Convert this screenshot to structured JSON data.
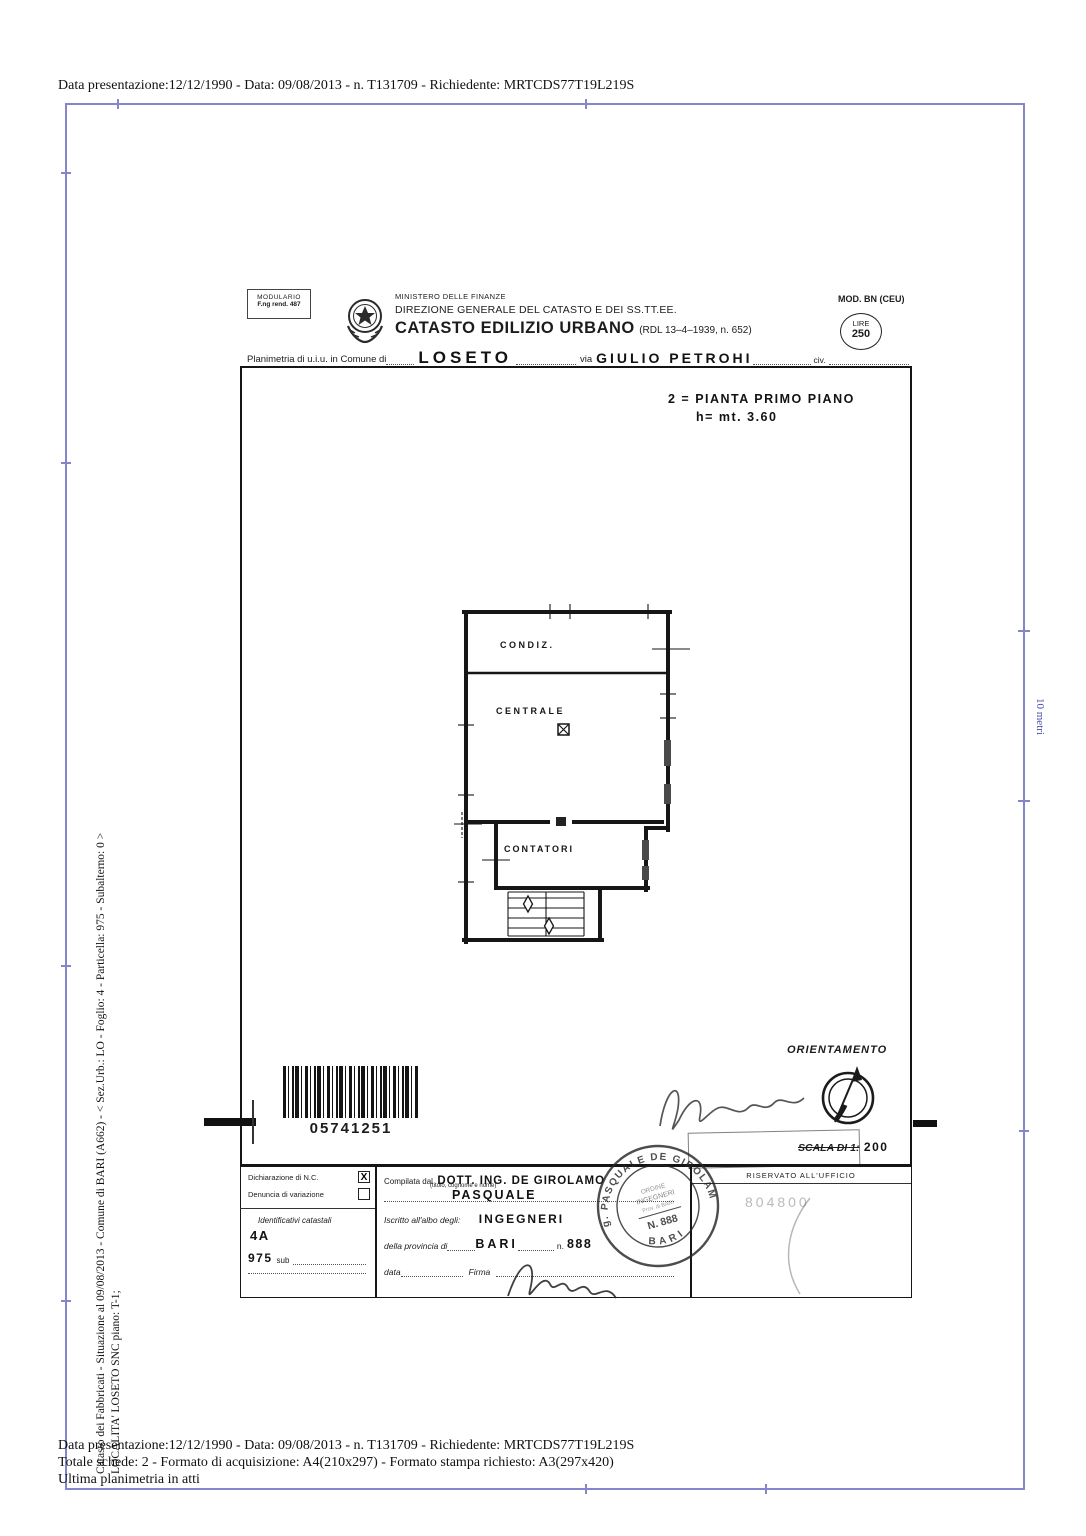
{
  "meta": {
    "top_line": "Data presentazione:12/12/1990 - Data: 09/08/2013 - n. T131709 - Richiedente: MRTCDS77T19L219S",
    "bottom_line1": "Data presentazione:12/12/1990 - Data: 09/08/2013 - n. T131709 - Richiedente: MRTCDS77T19L219S",
    "bottom_line2": "Totale schede: 2 - Formato di acquisizione: A4(210x297)  - Formato stampa richiesto: A3(297x420)",
    "bottom_line3": "Ultima planimetria in atti",
    "side_line1": "Catasto dei Fabbricati - Situazione al 09/08/2013 - Comune di BARI (A662) - < Sez.Urb.: LO - Foglio: 4 - Particella: 975 - Subalterno: 0 >",
    "side_line2": "LOCALITA' LOSETO SNC piano: T-1;",
    "scale_bar_label": "10 metri"
  },
  "header": {
    "modulario_line1": "MODULARIO",
    "modulario_line2": "F.ng rend. 487",
    "ministero": "MINISTERO DELLE FINANZE",
    "direzione": "DIREZIONE GENERALE DEL CATASTO E DEI SS.TT.EE.",
    "title": "CATASTO EDILIZIO URBANO",
    "title_ref": "(RDL 13–4–1939, n. 652)",
    "mod_label": "MOD. BN (CEU)",
    "lire_label": "LIRE",
    "lire_value": "250",
    "planimetria_label": "Planimetria di u.i.u. in Comune di",
    "comune_value": "LOSETO",
    "via_label": "via",
    "via_value": "GIULIO PETROHI",
    "civ_label": "civ."
  },
  "plan": {
    "annotation_line1": "2 = PIANTA PRIMO PIANO",
    "annotation_line2": "h= mt. 3.60",
    "room_condiz": "CONDIZ.",
    "room_centrale": "CENTRALE",
    "room_contatori": "CONTATORI",
    "barcode_number": "05741251",
    "orientamento_label": "ORIENTAMENTO",
    "scala_label": "SCALA DI 1:",
    "scala_value": "200"
  },
  "declaration": {
    "row1_label": "Dichiarazione di N.C.",
    "row1_mark": "X",
    "row2_label": "Denuncia di variazione",
    "row2_mark": "",
    "identificativi_label": "Identificativi catastali",
    "foglio_value": "4A",
    "particella_value": "975",
    "sub_label": "sub"
  },
  "compiler": {
    "compilata_label": "Compilata dal",
    "name_value": "DOTT. ING. DE GIROLAMO",
    "name_hint": "(titolo, cognome e nome)",
    "firstname_value": "PASQUALE",
    "albo_label": "Iscritto all'albo degli:",
    "albo_value": "INGEGNERI",
    "provincia_label": "della provincia di",
    "provincia_value": "BARI",
    "n_label": "n.",
    "n_value": "888",
    "data_label": "data",
    "firma_label": "Firma"
  },
  "office": {
    "riservato_label": "RISERVATO ALL'UFFICIO",
    "faint_number": "804800"
  },
  "stamp": {
    "arc_text": "Ing. PASQUALE DE GIROLAMO",
    "bottom_text": "BARI",
    "inner_line1": "ORDINE",
    "inner_line2": "INGEGNERI",
    "inner_line3": "Prov. di BARI",
    "number": "N. 888"
  }
}
